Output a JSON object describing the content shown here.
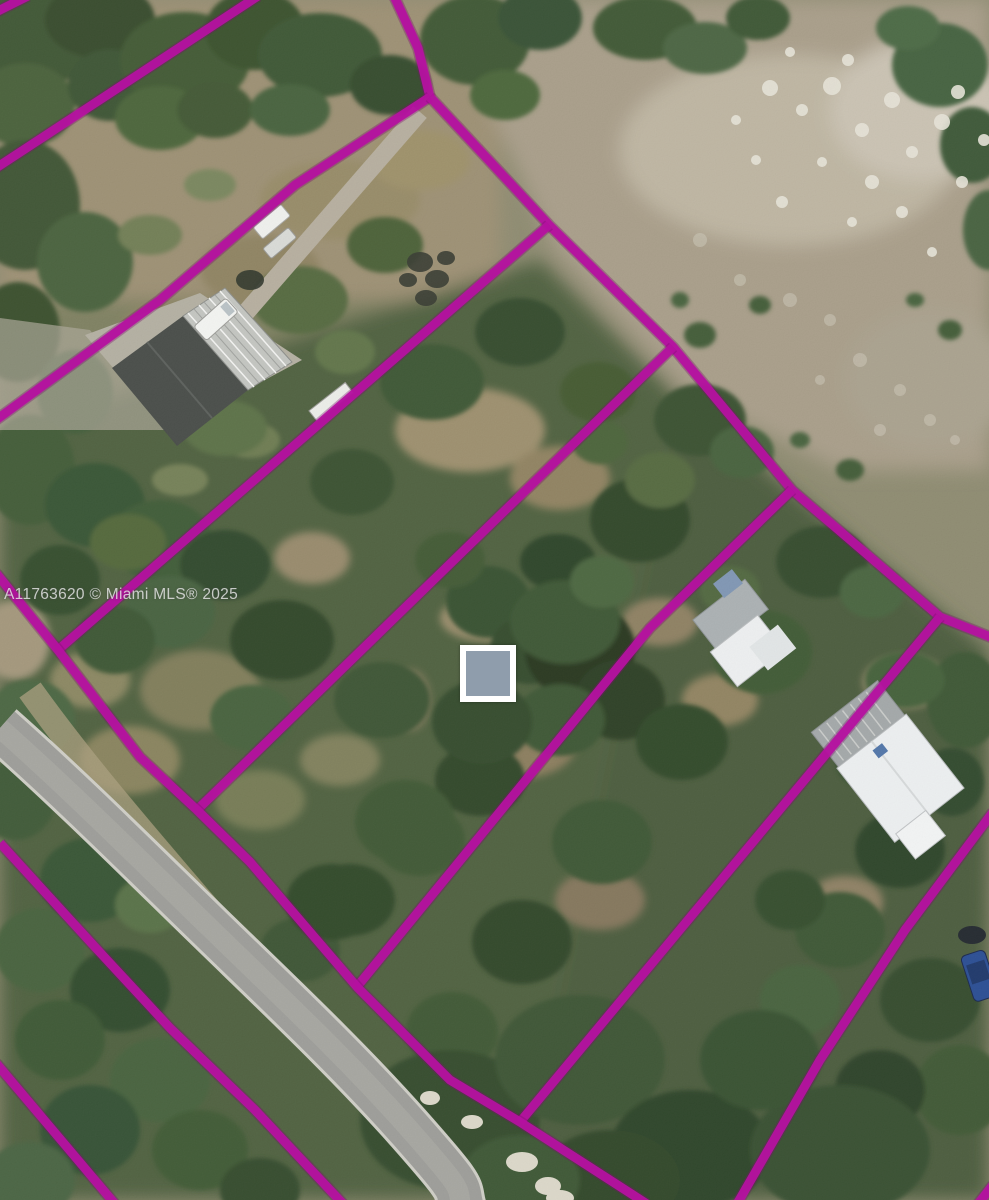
{
  "image": {
    "width": 989,
    "height": 1200,
    "kind": "aerial satellite photo with parcel boundary overlay"
  },
  "watermark": {
    "text": "A11763620 © Miami MLS® 2025",
    "x": 4,
    "y": 586,
    "font_size": 15.5,
    "color": "rgba(238,238,238,0.78)"
  },
  "overlay": {
    "boundary_color": "#b511a0",
    "boundary_underglow": "#7c0e6e",
    "boundary_width": 9,
    "parcel_lines": [
      {
        "name": "corner-northwest",
        "points": [
          [
            28,
            -4
          ],
          [
            -4,
            12
          ]
        ]
      },
      {
        "name": "lot-line-a",
        "points": [
          [
            258,
            -4
          ],
          [
            -4,
            168
          ]
        ]
      },
      {
        "name": "lot-line-b-stem",
        "points": [
          [
            394,
            -4
          ],
          [
            418,
            48
          ],
          [
            430,
            97
          ]
        ]
      },
      {
        "name": "lot-line-b",
        "points": [
          [
            430,
            97
          ],
          [
            295,
            185
          ],
          [
            160,
            300
          ],
          [
            -4,
            420
          ]
        ]
      },
      {
        "name": "northeast-boundary",
        "points": [
          [
            430,
            97
          ],
          [
            549,
            225
          ],
          [
            673,
            347
          ],
          [
            792,
            490
          ],
          [
            940,
            617
          ],
          [
            993,
            638
          ]
        ]
      },
      {
        "name": "lot-line-c",
        "points": [
          [
            549,
            225
          ],
          [
            58,
            650
          ]
        ]
      },
      {
        "name": "lot-line-d",
        "points": [
          [
            673,
            347
          ],
          [
            197,
            810
          ]
        ]
      },
      {
        "name": "lot-line-e",
        "points": [
          [
            792,
            490
          ],
          [
            650,
            628
          ],
          [
            356,
            988
          ]
        ]
      },
      {
        "name": "lot-line-f",
        "points": [
          [
            940,
            617
          ],
          [
            520,
            1122
          ]
        ]
      },
      {
        "name": "road-east-boundary",
        "points": [
          [
            -4,
            573
          ],
          [
            58,
            650
          ],
          [
            140,
            757
          ],
          [
            197,
            810
          ],
          [
            250,
            862
          ],
          [
            358,
            988
          ],
          [
            450,
            1080
          ],
          [
            520,
            1122
          ],
          [
            647,
            1204
          ]
        ]
      },
      {
        "name": "road-west-line",
        "points": [
          [
            0,
            843
          ],
          [
            95,
            947
          ],
          [
            170,
            1028
          ],
          [
            255,
            1110
          ],
          [
            345,
            1206
          ]
        ]
      },
      {
        "name": "west-lot-line",
        "points": [
          [
            -4,
            1063
          ],
          [
            115,
            1204
          ]
        ]
      },
      {
        "name": "lot-line-g",
        "points": [
          [
            993,
            812
          ],
          [
            905,
            930
          ],
          [
            820,
            1060
          ],
          [
            737,
            1204
          ]
        ]
      },
      {
        "name": "corner-southeast",
        "points": [
          [
            993,
            1185
          ],
          [
            978,
            1204
          ]
        ]
      }
    ],
    "marker": {
      "x": 460,
      "y": 645,
      "width": 56,
      "height": 57,
      "border_width": 6,
      "border_color": "#ffffff",
      "fill_color": "#8f9dac"
    }
  },
  "scene": {
    "features": [
      "paved rural road",
      "dirt driveway and parking pad",
      "metal-roof farm building",
      "residence with white roof (center-right)",
      "residence with white roof (lower-right)",
      "wooded strip parcels",
      "open limestone field (upper-right)",
      "parked vehicles"
    ]
  }
}
